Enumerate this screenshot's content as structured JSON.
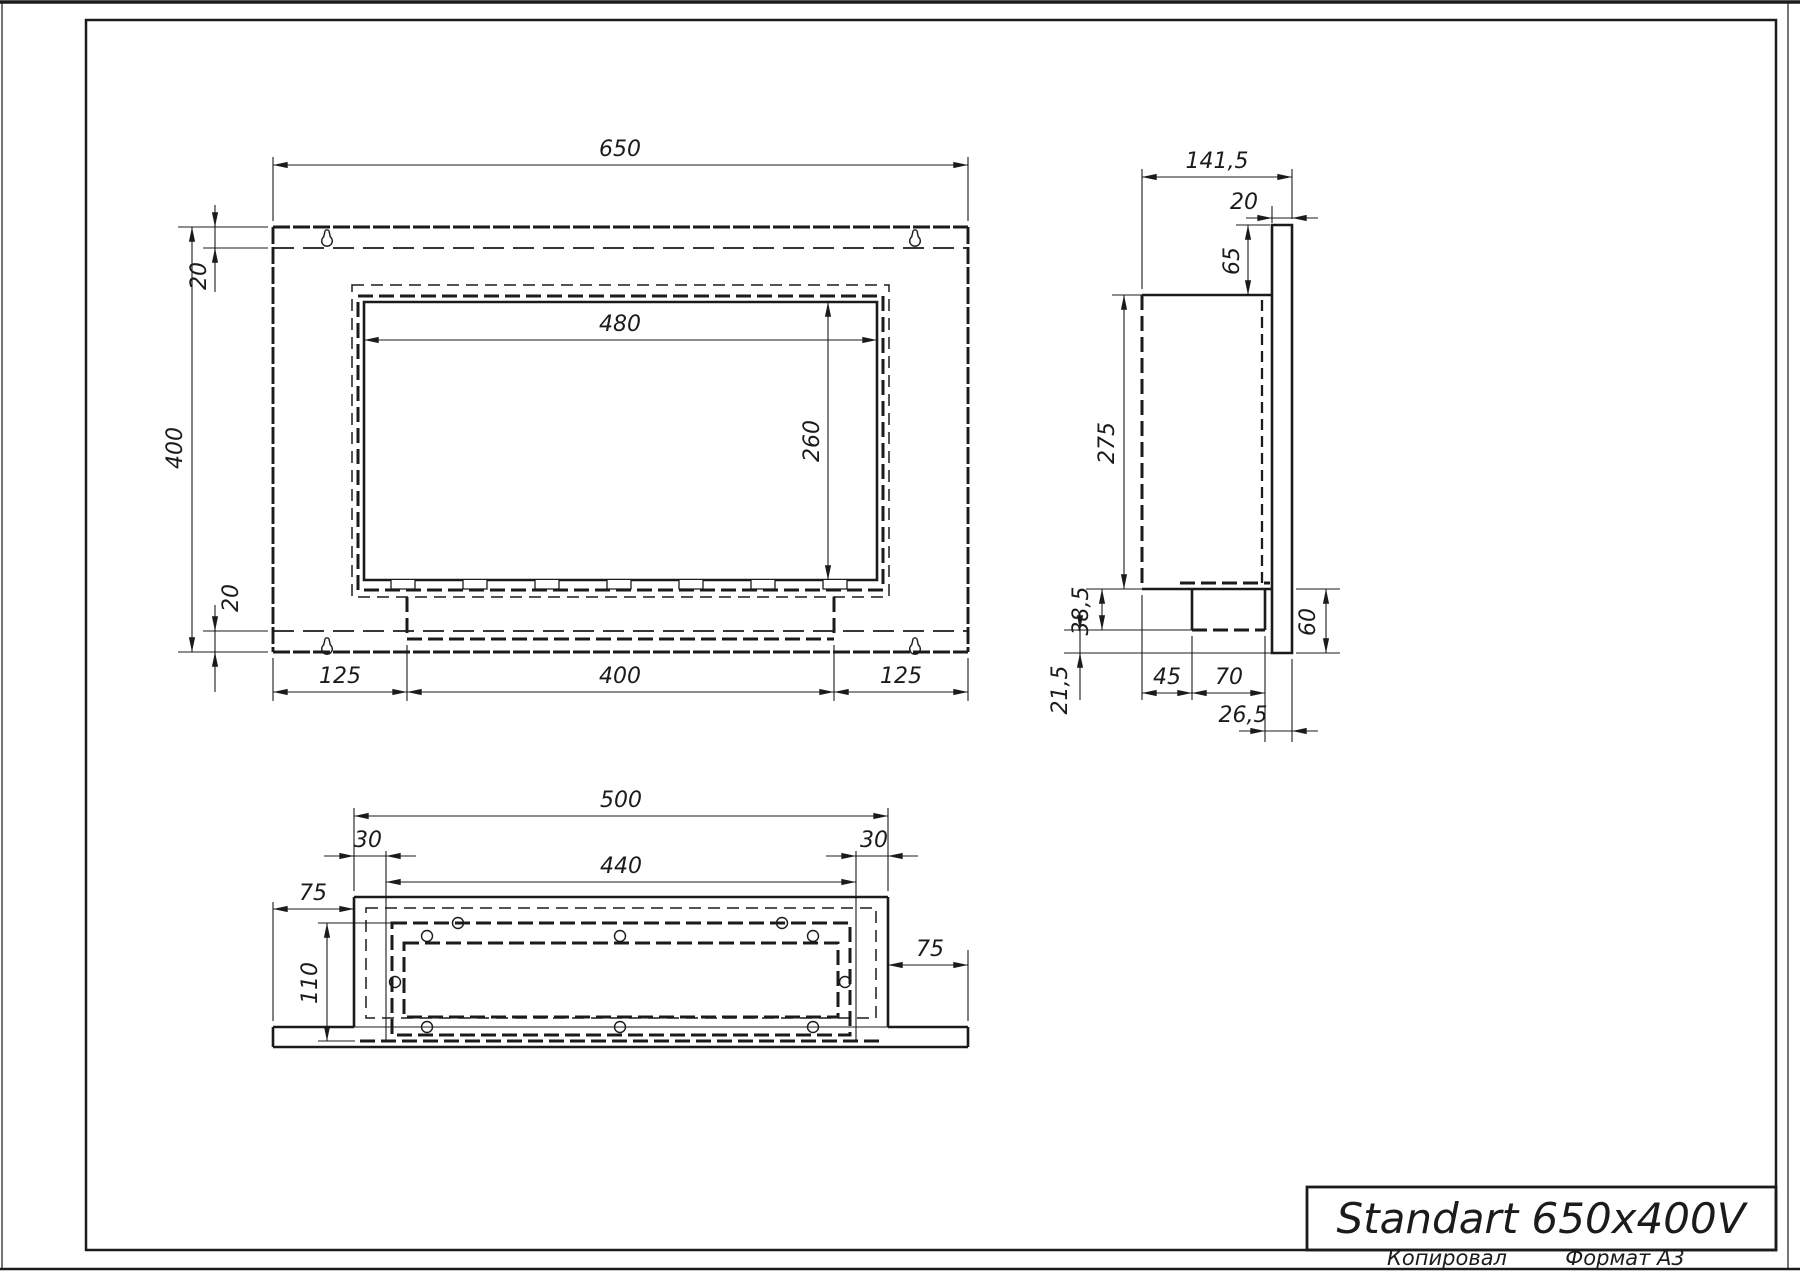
{
  "title_block": {
    "title": "Standart 650x400V"
  },
  "footer": {
    "copied": "Копировал",
    "format": "Формат А3"
  },
  "colors": {
    "line": "#1b1b1b",
    "background": "#ffffff"
  },
  "dims": {
    "front": {
      "total_width": "650",
      "total_height": "400",
      "top_offset": "20",
      "bottom_offset": "20",
      "opening_width": "480",
      "opening_height": "260",
      "left_margin": "125",
      "center_width": "400",
      "right_margin": "125"
    },
    "side": {
      "total_depth": "141,5",
      "flange_thickness": "20",
      "flange_top_ext": "65",
      "body_height": "275",
      "burner_drop": "38,5",
      "flange_below": "21,5",
      "body_inset": "45",
      "burner_depth": "70",
      "rear_offset": "26,5",
      "flange_bottom_ext": "60"
    },
    "bottom": {
      "body_width": "500",
      "side_inset_left": "30",
      "side_inset_right": "30",
      "inner_width": "440",
      "flange_left": "75",
      "inner_depth": "110",
      "flange_right": "75"
    }
  }
}
